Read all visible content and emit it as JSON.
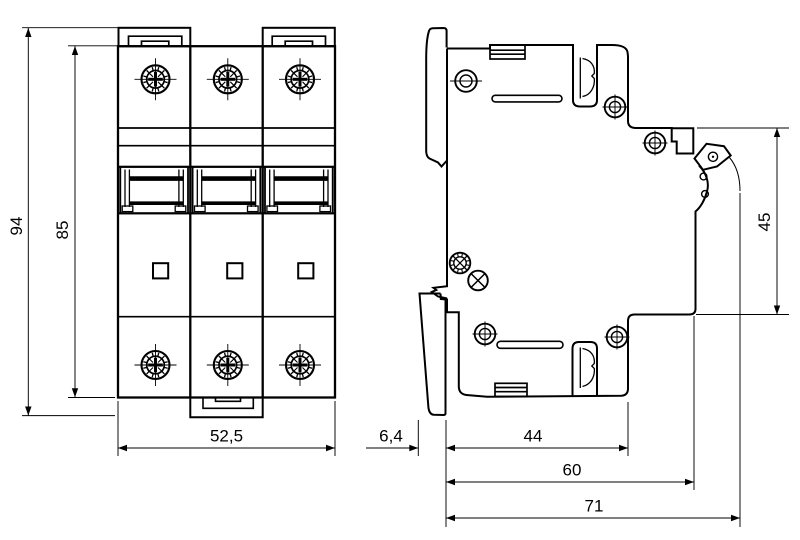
{
  "drawing": {
    "type": "technical-dimension-drawing",
    "background": "#ffffff",
    "line_color": "#000000",
    "views": {
      "front": {
        "dimensions": {
          "total_height": "94",
          "body_height": "85",
          "width": "52,5"
        }
      },
      "side": {
        "dimensions": {
          "front_height": "45",
          "din_offset": "6,4",
          "body_depth": "44",
          "depth_to_front": "60",
          "total_depth": "71"
        }
      }
    }
  }
}
